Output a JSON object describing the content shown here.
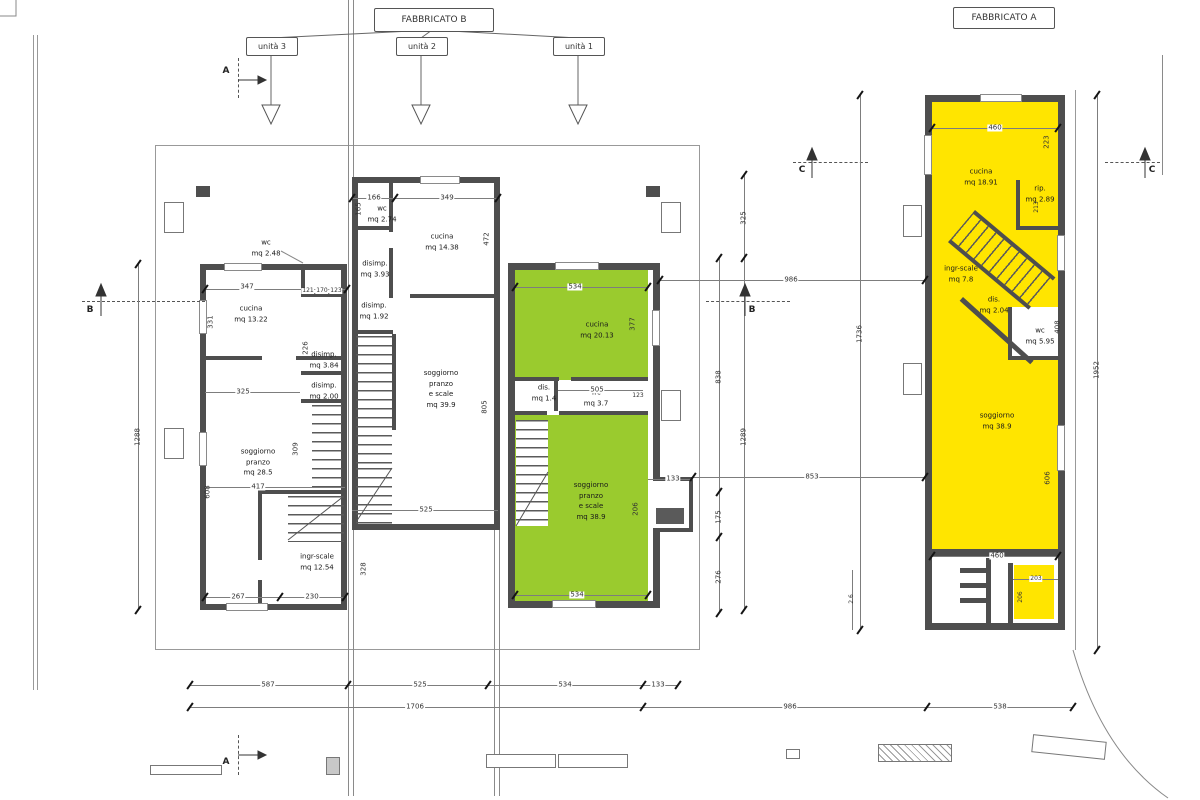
{
  "title_tree": {
    "fabbricato_b": "FABBRICATO B",
    "fabbricato_a": "FABBRICATO A",
    "units": [
      "unità 3",
      "unità 2",
      "unità 1"
    ]
  },
  "sections": {
    "a": "A",
    "b": "B",
    "c": "C"
  },
  "colors": {
    "unit1_fill": "#9ACB2E",
    "fabbricato_a_fill": "#FFE500",
    "wall": "#4E4E4E"
  },
  "unit3": {
    "rooms": [
      {
        "label": "wc\nmq 2.48"
      },
      {
        "label": "cucina\nmq 13.22"
      },
      {
        "label": "disimp.\nmq 3.84"
      },
      {
        "label": "disimp.\nmq 2.00"
      },
      {
        "label": "soggiorno\npranzo\nmq 28.5"
      },
      {
        "label": "ingr-scale\nmq 12.54"
      }
    ],
    "dims": [
      "347",
      "331",
      "121",
      "170",
      "123",
      "226",
      "325",
      "309",
      "417",
      "608",
      "267",
      "230",
      "1288"
    ]
  },
  "unit2": {
    "rooms": [
      {
        "label": "wc\nmq 2.74"
      },
      {
        "label": "cucina\nmq 14.38"
      },
      {
        "label": "disimp.\nmq 3.93"
      },
      {
        "label": "disimp.\nmq 1.92"
      },
      {
        "label": "soggiorno\npranzo\ne scale\nmq 39.9"
      }
    ],
    "dims": [
      "166",
      "349",
      "165",
      "472",
      "805",
      "525",
      "328"
    ]
  },
  "unit1": {
    "rooms": [
      {
        "label": "cucina\nmq 20.13"
      },
      {
        "label": "dis.\nmq 1.4"
      },
      {
        "label": "wc\nmq 3.7"
      },
      {
        "label": "soggiorno\npranzo\ne scale\nmq 38.9"
      }
    ],
    "dims": [
      "534",
      "377",
      "505",
      "123",
      "133",
      "206",
      "534"
    ]
  },
  "fabbricato_a_plan": {
    "rooms": [
      {
        "label": "cucina\nmq 18.91"
      },
      {
        "label": "rip.\nmq 2.89"
      },
      {
        "label": "ingr-scale\nmq 7.8"
      },
      {
        "label": "dis.\nmq 2.04"
      },
      {
        "label": "wc\nmq 5.95"
      },
      {
        "label": "soggiorno\nmq 38.9"
      }
    ],
    "dims": [
      "460",
      "223",
      "213",
      "408",
      "606",
      "460",
      "203",
      "206",
      "1736",
      "2.6",
      "1952"
    ]
  },
  "site_dims": {
    "between": [
      "325",
      "838",
      "1289",
      "175",
      "276",
      "986",
      "853"
    ],
    "bottom_row1": [
      "587",
      "525",
      "534",
      "133"
    ],
    "bottom_row2": [
      "1706",
      "986",
      "538"
    ]
  }
}
